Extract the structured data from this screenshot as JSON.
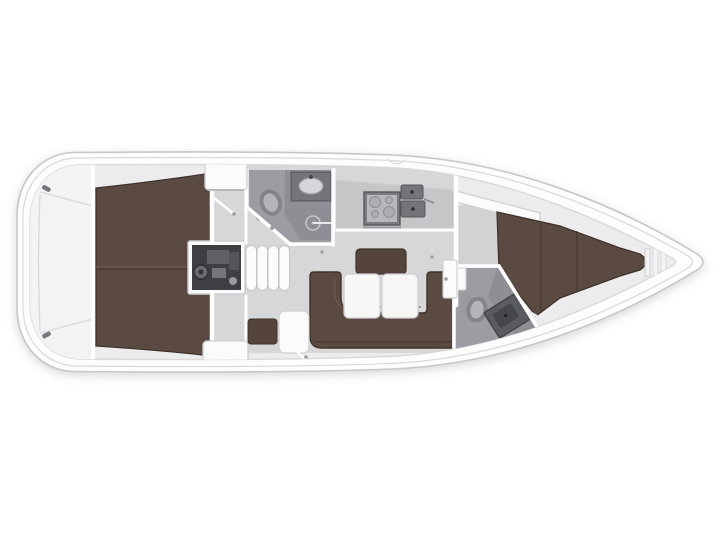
{
  "image_kind": "yacht-interior-floor-plan",
  "orientation": "bow-right",
  "colors": {
    "page": "#ffffff",
    "hullFill": "#fdfdfe",
    "hullLine": "#c7c7cb",
    "deckLine": "#d9d9dc",
    "interiorBase": "#ececee",
    "sternFloor": "#f3f3f5",
    "corridor": "#e2e2e4",
    "salonFloor": "#d7d7d9",
    "fwdFloor": "#d2d2d5",
    "headFloor": "#9c9ca2",
    "showerFloor": "#8e8e94",
    "wall": "#ffffff",
    "brown": "#5b4a41",
    "brownDark": "#3f322b",
    "brownSeam": "#6e5a4e",
    "benchBrown": "#55443a",
    "furnitureWhite": "#fbfbfc",
    "furnitureLine": "#cfcfd3",
    "tableWhite": "#f7f7f8",
    "counter": "#c6c6c9",
    "steel": "#b7b7bc",
    "steelDark": "#7b7b82",
    "sinkBasin": "#74747b",
    "engine": "#3e3e43",
    "engineLite": "#6a6a70",
    "fixtureGray": "#84848b",
    "fixtureLite": "#b3b3b8",
    "dotGray": "#9b9ba1",
    "cleat": "#75757c"
  },
  "regions": [
    "hull",
    "stern-lazarette",
    "aft-double-berth",
    "engine-compartment",
    "companionway-steps",
    "starboard-corridor",
    "port-corridor",
    "aft-head",
    "aft-head-shower",
    "galley",
    "galley-stove",
    "galley-sinks",
    "salon",
    "dinette-table",
    "u-settee",
    "salon-bench",
    "nav-locker",
    "forward-bulkhead",
    "forward-cabin",
    "v-berth",
    "forward-head",
    "bow-anchor-locker"
  ]
}
